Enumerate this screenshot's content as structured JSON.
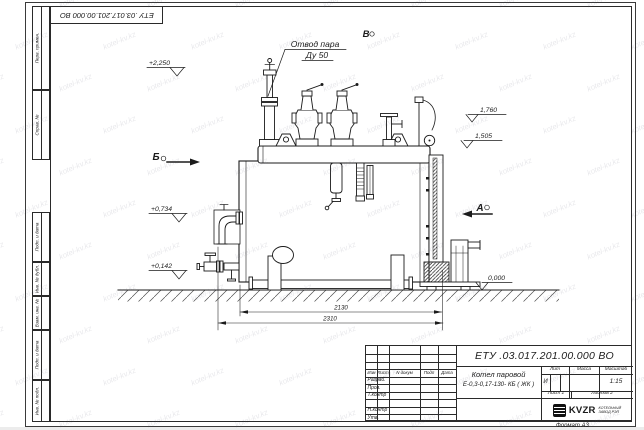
{
  "sheet": {
    "designation": "ЕТУ .03.017.201.00.000 ВО",
    "format_label": "Формат А3"
  },
  "margin_columns": {
    "top": [
      "Перв. примен.",
      "Справ. №"
    ],
    "bottom": [
      "Подп. и дата",
      "Инв. № дубл.",
      "Взам. инв. №",
      "Подп. и дата",
      "Инв. № подл."
    ]
  },
  "title_block": {
    "designation": "ЕТУ .03.017.201.00.000 ВО",
    "product_name": "Котел паровой",
    "product_code": "Е-0,3-0,17-130- КБ ( ЖК )",
    "change_header": [
      "Изм",
      "Лист",
      "N докум",
      "Подп",
      "Дата"
    ],
    "staff_rows": [
      "Разраб.",
      "Пров.",
      "Т.контр",
      "",
      "Н.контр",
      "Утв."
    ],
    "lit_label": "Лит",
    "mass_label": "Масса",
    "scale_label": "Масштаб",
    "lit_value": "И",
    "scale_value": "1:15",
    "sheet_label": "Лист",
    "sheet_number": "1",
    "sheets_label": "Листов",
    "sheets_total": "2",
    "company_name": "KVZR",
    "company_tagline_line1": "КОТЕЛЬНЫЙ",
    "company_tagline_line2": "ЗАВОД РЭП"
  },
  "drawing": {
    "callout": {
      "line1": "Отвод пара",
      "line2": "Ду 50"
    },
    "views": {
      "top": "В",
      "left": "Б",
      "right": "А"
    },
    "elevations": {
      "valve_top": "+2,250",
      "burner": "+0,734",
      "drain": "+0,142",
      "right_upper": "1,760",
      "right_lower": "1,505",
      "ground": "0,000"
    },
    "dimensions": {
      "boiler_length": "2130",
      "overall_length": "2310"
    }
  },
  "watermark": {
    "text": "kotel-kv.kz"
  }
}
